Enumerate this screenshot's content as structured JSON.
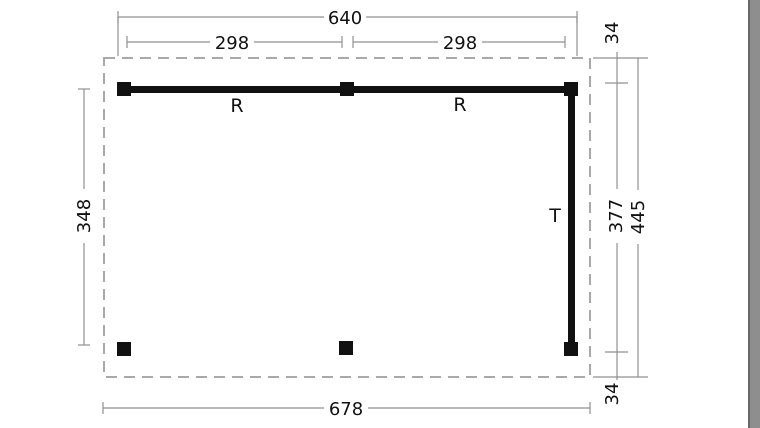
{
  "canvas": {
    "background": "#ffffff",
    "colors": {
      "beam": "#111111",
      "dim_line": "#919191",
      "dashed_outline": "#a9a9a9",
      "text": "#111111",
      "right_band": "#8e8e8e",
      "right_band_edge": "#686868"
    }
  },
  "plan": {
    "dimensions": {
      "top_total_width": "640",
      "top_left_segment": "298",
      "top_right_segment": "298",
      "left_depth": "348",
      "right_top_offset": "34",
      "right_inner_depth": "377",
      "right_total_depth": "445",
      "right_bottom_offset": "34",
      "bottom_total_width": "678"
    },
    "part_labels": {
      "beam_left": "R",
      "beam_right": "R",
      "beam_side": "T"
    }
  }
}
